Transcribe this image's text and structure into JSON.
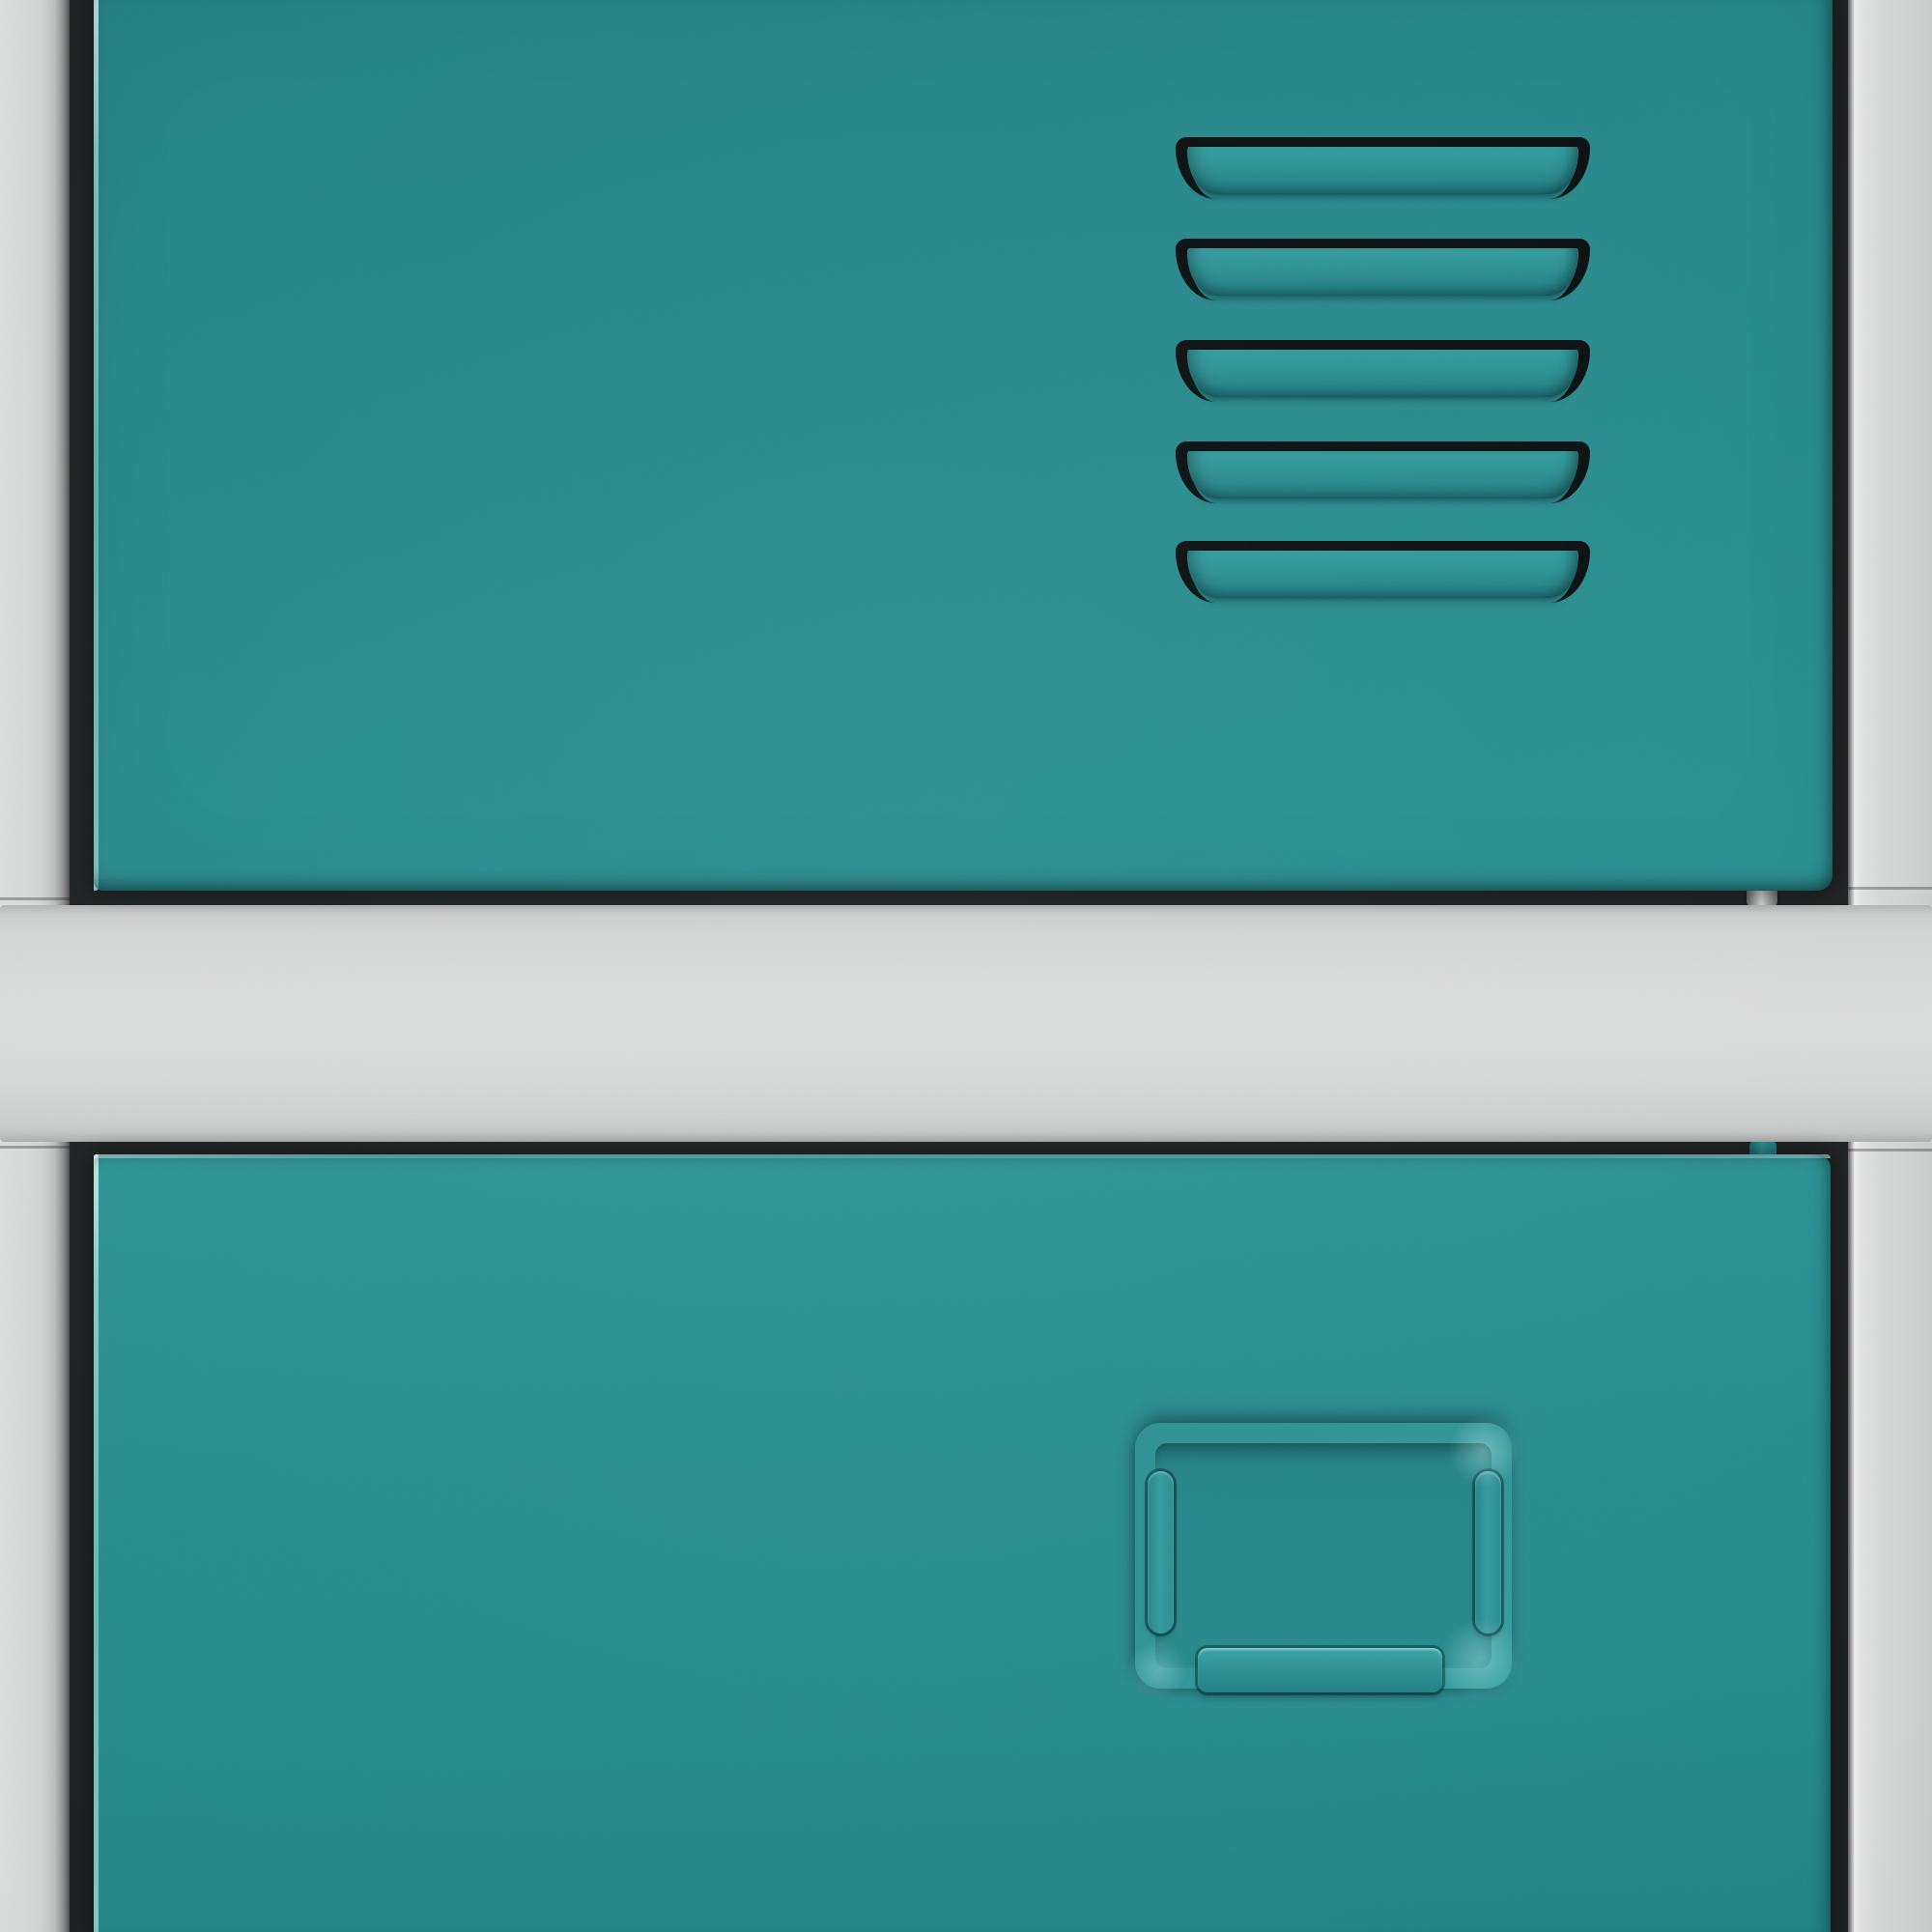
{
  "scene": {
    "type": "photographic close-up render",
    "subject": "stacked metal lockers: teal doors in a light gray steel frame",
    "visible_text": "none"
  },
  "palette": {
    "teal_base": "#28898B",
    "teal_top_shade": "#237E81",
    "teal_edge_highlight": "#A8E3E0",
    "louver_face_hi": "#339A9D",
    "louver_face_lo": "#1A6C6F",
    "slot_black": "#0A1011",
    "ridge_teal": "#2E9193",
    "tab_teal_hi": "#3AA2A3",
    "gray_frame": "#D6D7D7",
    "gray_frame_dark": "#9C9D9D",
    "gray_edge_bright": "#ECEDED",
    "gap_dark": "#1F2223"
  },
  "frame": {
    "left_rail": true,
    "right_rail": true,
    "horizontal_band_between_doors": true
  },
  "upper_door": {
    "color_name": "teal",
    "vent": {
      "louver_count": 5,
      "louver_tops": [
        146,
        251,
        356,
        461,
        564
      ]
    },
    "hinge_pin_visible_below": true
  },
  "lower_door": {
    "color_name": "teal",
    "label_card_holder": {
      "side_tabs": 2,
      "bottom_tab": 1,
      "card_inserted": false
    },
    "hinge_pin_visible_above": true
  }
}
